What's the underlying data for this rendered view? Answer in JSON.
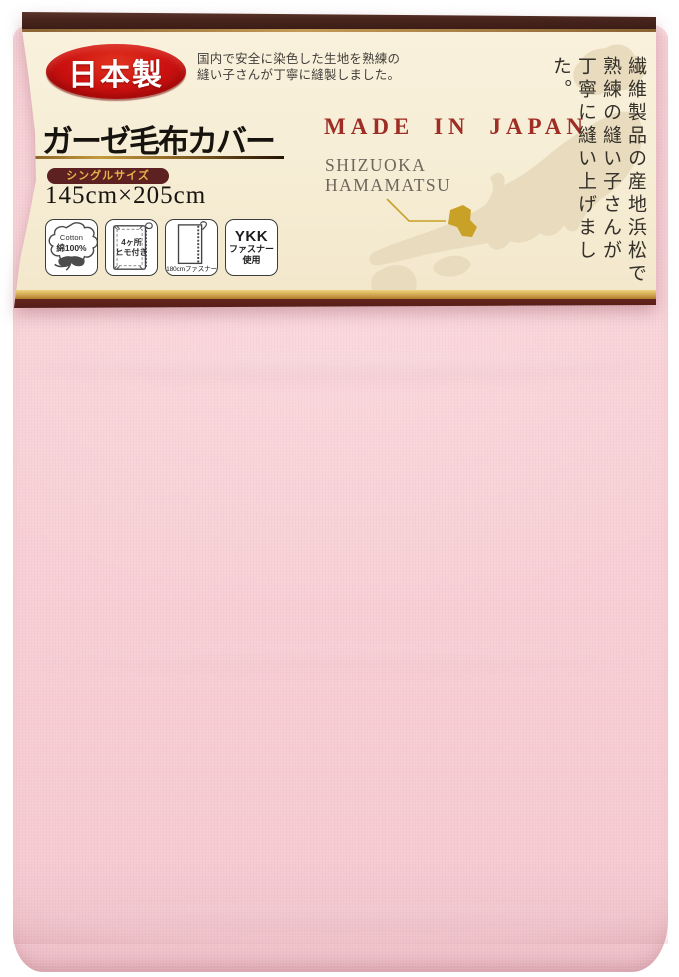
{
  "badge": {
    "label": "日本製"
  },
  "description": {
    "line1": "国内で安全に染色した生地を熟練の",
    "line2": "縫い子さんが丁寧に縫製しました。"
  },
  "product": {
    "title": "ガーゼ毛布カバー",
    "size_badge": "シングルサイズ",
    "dimensions": "145cm×205cm"
  },
  "features": [
    {
      "name": "cotton",
      "line1": "Cotton",
      "line2": "綿100%"
    },
    {
      "name": "ties",
      "line1": "4ヶ所",
      "line2": "ヒモ付き"
    },
    {
      "name": "fastener-length",
      "caption": "180cmファスナー"
    },
    {
      "name": "ykk",
      "line1": "YKK",
      "line2": "ファスナー",
      "line3": "使用"
    }
  ],
  "origin": {
    "heading": "MADE IN JAPAN",
    "region_line1": "SHIZUOKA",
    "region_line2": "HAMAMATSU"
  },
  "vertical_copy": {
    "col1": "繊維製品の産地浜松で",
    "col2": "熟練の縫い子さんが",
    "col3": "丁寧に縫い上げました。"
  },
  "icons": {
    "feature_icons": [
      "cotton-flower-icon",
      "blanket-with-ties-icon",
      "zipper-icon"
    ],
    "map": "japan-map-silhouette"
  },
  "colors": {
    "fabric_pink": "#f8d0d5",
    "label_cream": "#f6edd5",
    "top_bar_brown": "#47241d",
    "bottom_bar_maroon": "#551e18",
    "gold_accent": "#c49a3e",
    "badge_red": "#cb1110",
    "made_in_japan_red": "#9e2d25",
    "size_pill_maroon": "#5c2120",
    "size_pill_gold": "#e9b04b",
    "map_beige": "#e9dbbd"
  }
}
